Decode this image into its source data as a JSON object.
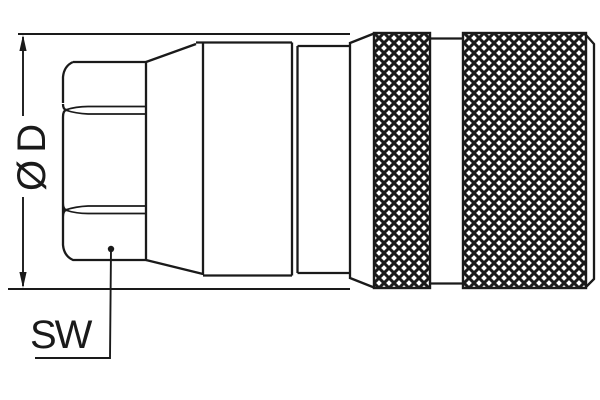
{
  "labels": {
    "diameter": "Ø D",
    "wrench_size": "SW"
  },
  "colors": {
    "line": "#1a1a1a",
    "background": "#ffffff"
  },
  "drawing": {
    "type": "technical-line-drawing",
    "view": "side-view-quick-coupling",
    "parts": {
      "hex_nut": "hex-nut",
      "cone": "tapered-cone",
      "sleeve": "stepped-sleeve",
      "knurl_left": "knurled-band",
      "knurl_right": "knurled-band"
    }
  }
}
